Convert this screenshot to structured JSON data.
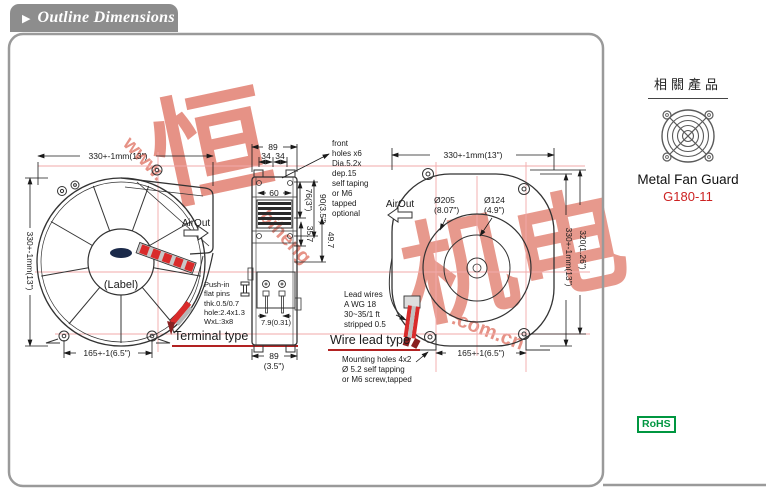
{
  "header": {
    "bullet_icon": "▶",
    "title": "Outline Dimensions"
  },
  "watermark": {
    "chars_left": "恒",
    "chars_right": "机电",
    "url_start": "www.",
    "url_mid": "biheng",
    "url_end": ".com.cn"
  },
  "front_view": {
    "dim_width": "330+-1mm(13\")",
    "dim_height": "330+-1mm(13\")",
    "dim_hole_span": "165+-1(6.5\")",
    "air_out": "AirOut",
    "center_label": "(Label)",
    "pushin_line1": "Push-in",
    "pushin_line2": "flat pins",
    "pushin_line3": "thk.0.5/0.7",
    "pushin_line4": "hole:2.4x1.3",
    "pushin_line5": "WxL:3x8",
    "caption": "Terminal type"
  },
  "side_view": {
    "dim_width": "89",
    "dim_half_a": "34",
    "dim_half_b": "34",
    "dim_vent": "60",
    "dim_76": "76(3\")",
    "dim_90": "90(3.5\")",
    "dim_357": "35.7",
    "dim_497": "49.7",
    "dim_pin": "7.9(0.31)",
    "dim_depth": "89",
    "dim_depth_in": "(3.5\")",
    "holes_line1": "front",
    "holes_line2": "holes x6",
    "holes_line3": "Dia.5.2x",
    "holes_line4": "dep.15",
    "holes_line5": "self taping",
    "holes_line6": "or M6",
    "holes_line7": "tapped",
    "holes_line8": "optional"
  },
  "wire_section": {
    "lead_line1": "Lead wires",
    "lead_line2": "A WG 18",
    "lead_line3": "30~35/1 ft",
    "lead_line4": "stripped 0.5",
    "caption": "Wire lead type",
    "mount_line1": "Mounting holes 4x2",
    "mount_line2": "Ø 5.2 self tapping",
    "mount_line3": "or M6 screw,tapped"
  },
  "back_view": {
    "dim_width": "330+-1mm(13\")",
    "dim_d205": "Ø205",
    "dim_d205_in": "(8.07\")",
    "dim_d124": "Ø124",
    "dim_d124_in": "(4.9\")",
    "air_out": "AirOut",
    "dim_320": "320(1.26\")",
    "dim_height": "330+-1mm(13\")",
    "dim_hole_span": "165+-1(6.5\")"
  },
  "sidebar": {
    "related_title": "相關產品",
    "product_name": "Metal Fan Guard",
    "product_model": "G180-11",
    "rohs_label": "RoHS"
  },
  "colors": {
    "tab_gray": "#8d8d8d",
    "accent_red": "#cc2222",
    "rohs_green": "#009640",
    "centerline_pink": "#f2aaaa",
    "watermark_red": "#e07868"
  }
}
